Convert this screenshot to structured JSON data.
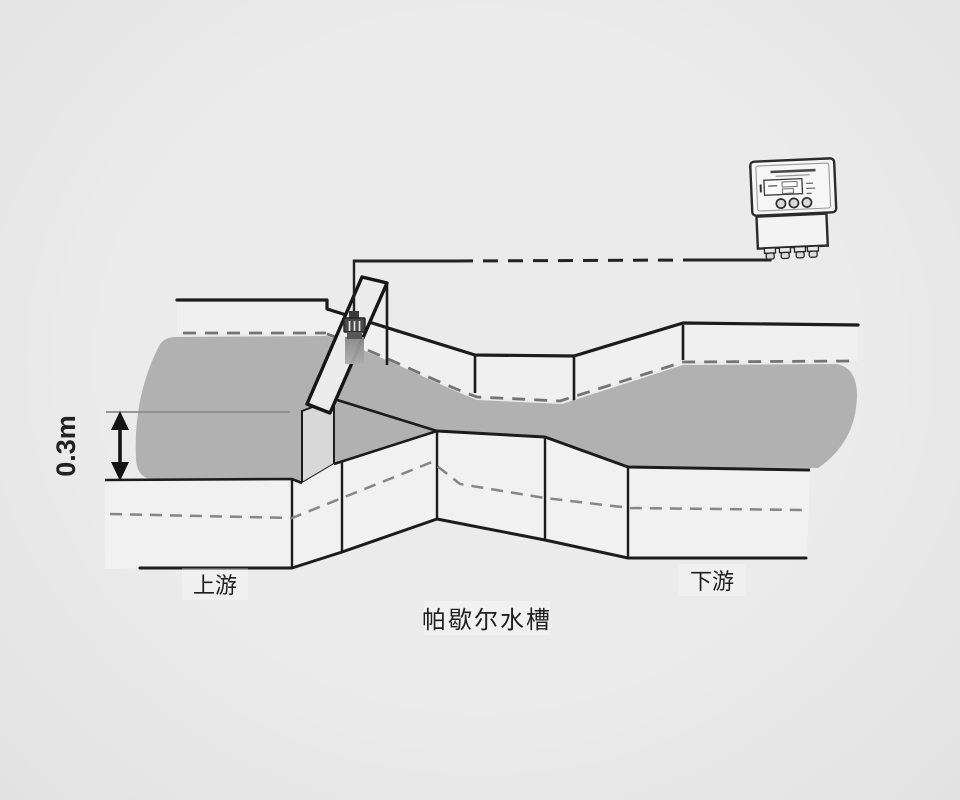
{
  "scene": {
    "type": "technical-diagram",
    "title": "帕歇尔水槽",
    "labels": {
      "upstream": "上游",
      "downstream": "下游",
      "flume_name": "帕歇尔水槽",
      "depth_dimension": "0.3m"
    },
    "components": {
      "flume": "Parshall flume open channel (converging inlet, throat, diverging outlet)",
      "water": "gray shaded water surface flowing left to right",
      "waterline": "dashed waterline along far wall",
      "ground_line": "dashed line across outer near wall",
      "plank": "diagonal mounting plank across channel",
      "sensor": "ultrasonic-level-sensor-icon",
      "sensor_beam": "measuring beam below sensor",
      "cable": "signal cable (solid-dashed-solid run) from sensor to transmitter",
      "transmitter": "wall-mounted ultrasonic flow transmitter",
      "transmitter_parts": [
        "nameplate",
        "lcd-display",
        "three-round-buttons",
        "terminal-box",
        "four-cable-glands"
      ],
      "dimension_arrow": "double-headed vertical arrow marking 0.3m water depth"
    },
    "colors": {
      "background": "#e9e9e9",
      "water": "#b1b1b1",
      "wall_face": "#f1f1f1",
      "far_wall_face": "#f0f0f0",
      "inner_face": "#d8d8d8",
      "line": "#1c1c1c",
      "dashed_waterline": "#747474",
      "dashed_ground": "#868686"
    }
  }
}
